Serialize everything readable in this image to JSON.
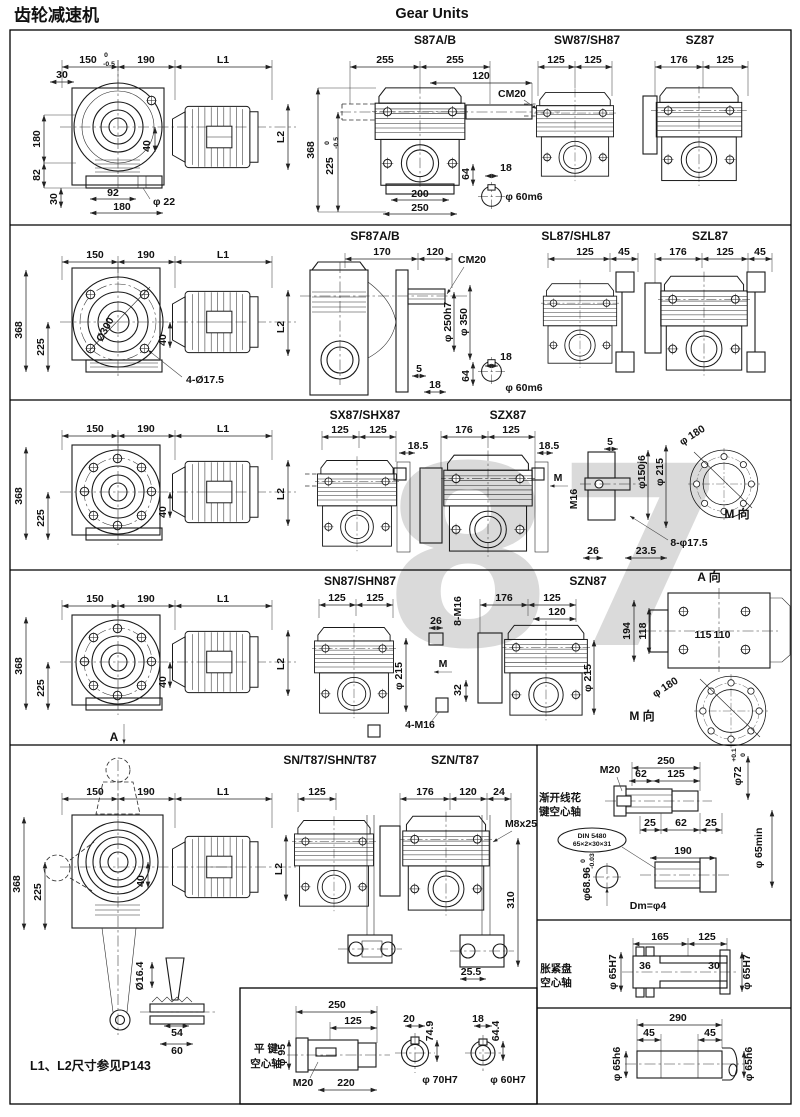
{
  "hd": {
    "cn": "齿轮减速机",
    "en": "Gear Units"
  },
  "wm": "87",
  "r1": {
    "side": {
      "d": [
        "150",
        "0",
        "-0.5",
        "190",
        "L1",
        "30",
        "180",
        "82",
        "30",
        "92",
        "180",
        "φ 22",
        "40",
        "L2"
      ]
    },
    "s87": {
      "t": "S87A/B",
      "d": [
        "255",
        "255",
        "120",
        "CM20",
        "368",
        "225",
        "0",
        "-0.5",
        "200",
        "250"
      ]
    },
    "sx": {
      "d": [
        "64",
        "18",
        "φ 60m6"
      ]
    },
    "sw87": {
      "t": "SW87/SH87",
      "d": [
        "125",
        "125"
      ]
    },
    "sz87": {
      "t": "SZ87",
      "d": [
        "176",
        "125"
      ]
    }
  },
  "r2": {
    "side": {
      "d": [
        "150",
        "190",
        "L1",
        "368",
        "225",
        "Ø300",
        "4-Ø17.5",
        "40",
        "L2"
      ]
    },
    "sf87": {
      "t": "SF87A/B",
      "d": [
        "170",
        "120",
        "CM20",
        "φ 250h7",
        "φ 350",
        "5",
        "18"
      ]
    },
    "sx": {
      "d": [
        "64",
        "18",
        "φ 60m6"
      ]
    },
    "sl87": {
      "t": "SL87/SHL87",
      "d": [
        "125",
        "45"
      ]
    },
    "szl87": {
      "t": "SZL87",
      "d": [
        "176",
        "125",
        "45"
      ]
    }
  },
  "r3": {
    "side": {
      "d": [
        "150",
        "190",
        "L1",
        "368",
        "225",
        "40",
        "L2"
      ]
    },
    "sx87": {
      "t": "SX87/SHX87",
      "d": [
        "125",
        "125",
        "18.5"
      ]
    },
    "szx87": {
      "t": "SZX87",
      "d": [
        "176",
        "125",
        "18.5"
      ]
    },
    "fl": {
      "d": [
        "M",
        "M16",
        "5",
        "φ150j6",
        "φ 215",
        "φ 180",
        "8-φ17.5",
        "26",
        "23.5",
        "M 向"
      ]
    }
  },
  "r4": {
    "side": {
      "d": [
        "150",
        "190",
        "L1",
        "368",
        "225",
        "40",
        "L2",
        "A"
      ]
    },
    "sn87": {
      "t": "SN87/SHN87",
      "d": [
        "125",
        "125",
        "26",
        "8-M16",
        "φ 215",
        "M",
        "32",
        "4-M16"
      ]
    },
    "szn87": {
      "t": "SZN87",
      "d": [
        "176",
        "125",
        "120",
        "φ 215"
      ]
    },
    "av": {
      "t": "A 向",
      "d": [
        "194",
        "118",
        "115",
        "110"
      ]
    },
    "mv": {
      "t": "M 向",
      "d": [
        "φ 180"
      ]
    }
  },
  "r5": {
    "side": {
      "d": [
        "150",
        "190",
        "L1",
        "368",
        "225",
        "40",
        "L2"
      ]
    },
    "snt": {
      "t": "SN/T87/SHN/T87",
      "d": [
        "125"
      ]
    },
    "sznt": {
      "t": "SZN/T87",
      "d": [
        "176",
        "120",
        "24",
        "M8x25",
        "310",
        "25.5"
      ]
    },
    "sp": {
      "l1": "渐开线花",
      "l2": "键空心轴",
      "d": [
        "250",
        "M20",
        "62",
        "125",
        "φ72",
        "+0.1",
        "0",
        "25",
        "62",
        "25",
        "DIN 5480",
        "65×2×30×31",
        "190",
        "φ68.96",
        "0",
        "-0.03",
        "φ 65min",
        "Dm=φ4"
      ]
    },
    "sd": {
      "l1": "胀紧盘",
      "l2": "空心轴",
      "d": [
        "165",
        "125",
        "φ 65H7",
        "36",
        "30",
        "φ 65H7"
      ]
    },
    "s290": {
      "d": [
        "290",
        "45",
        "45",
        "φ 65h6",
        "φ 65h6"
      ]
    }
  },
  "bt": {
    "key": {
      "d": [
        "Ø16.4",
        "54",
        "60"
      ]
    },
    "note": "L1、L2尺寸参见P143",
    "fk": {
      "l1": "平 键",
      "l2": "空心轴",
      "d": [
        "250",
        "125",
        "φ 95",
        "M20",
        "220",
        "20",
        "74.9",
        "φ 70H7",
        "18",
        "64.4",
        "φ 60H7"
      ]
    }
  }
}
